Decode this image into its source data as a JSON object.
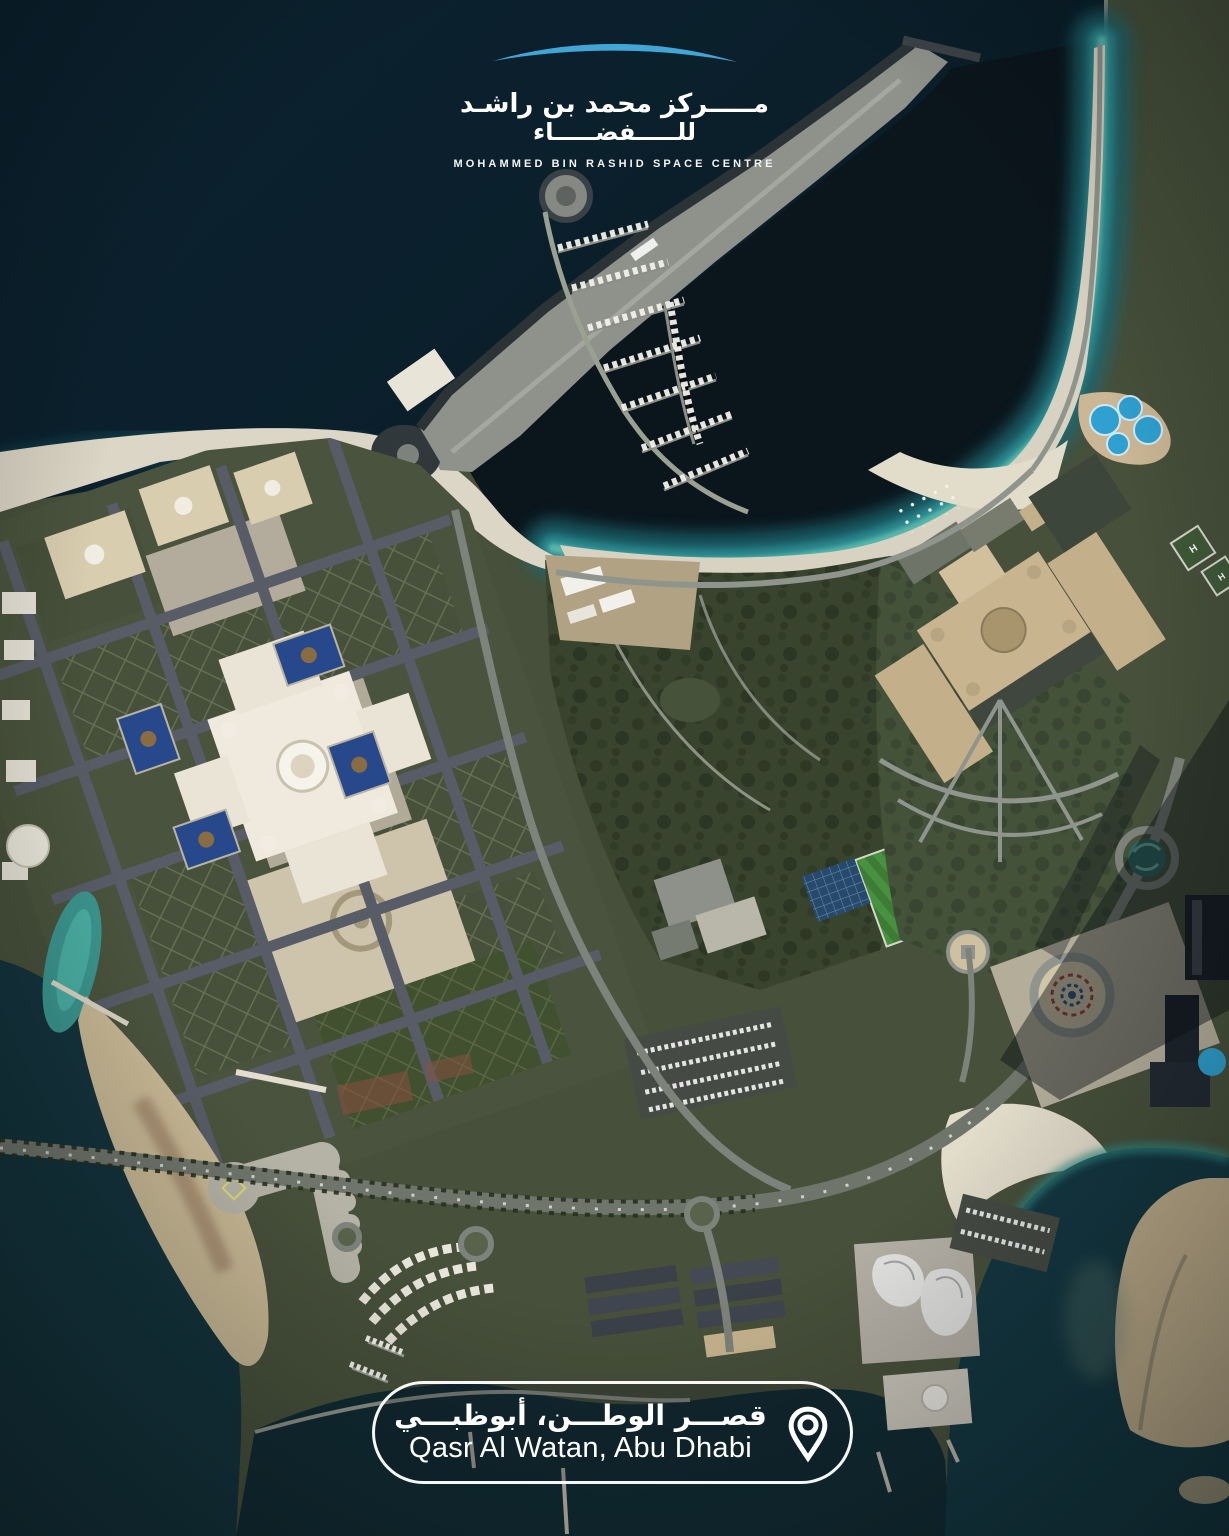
{
  "logo": {
    "mark": "swoosh-arc-icon",
    "mark_color": "#41a5d6",
    "arabic_line1": "مـــــركز محمد بن راشـد",
    "arabic_line2": "للـــــفضـــــاء",
    "english": "MOHAMMED BIN RASHID SPACE CENTRE"
  },
  "location_badge": {
    "arabic": "قصـــر الوطـــن، أبوظبـــي",
    "english": "Qasr Al Watan, Abu Dhabi",
    "icon": "location-pin-icon"
  },
  "map": {
    "type": "satellite-imagery",
    "helipad_label": "H",
    "palette": {
      "ocean-deep": "#0a1c26",
      "ocean-dark": "#081720",
      "shallow-teal": "#1d6871",
      "surf-teal": "#2f9094",
      "foam": "#5fbcae",
      "marina-water": "#0b151c",
      "harbor-water": "#14333c",
      "lagoon-teal": "#3b958e",
      "sand": "#d3ccba",
      "sand-bright": "#e7e1d1",
      "sand-tan": "#bfae8c",
      "spit-gray": "#8f918b",
      "rock": "#2c3337",
      "land": "#47503b",
      "land-light": "#59624a",
      "park": "#39442f",
      "tree": "#26301f",
      "field-green": "#3e7c36",
      "palace-white": "#efeadd",
      "cream": "#d9cdb0",
      "tan": "#c8b48e",
      "dome-tan": "#a8956e",
      "road": "#7d827a",
      "road-dark": "#575c66",
      "plaza": "#b5b2a6",
      "plaza-sand": "#cdc4ab",
      "pool-blue": "#27498c",
      "aqua": "#2fa0cf",
      "red-garden": "#8c4f3f",
      "shadow": "#0c1117",
      "logo-blue": "#41a5d6"
    }
  }
}
